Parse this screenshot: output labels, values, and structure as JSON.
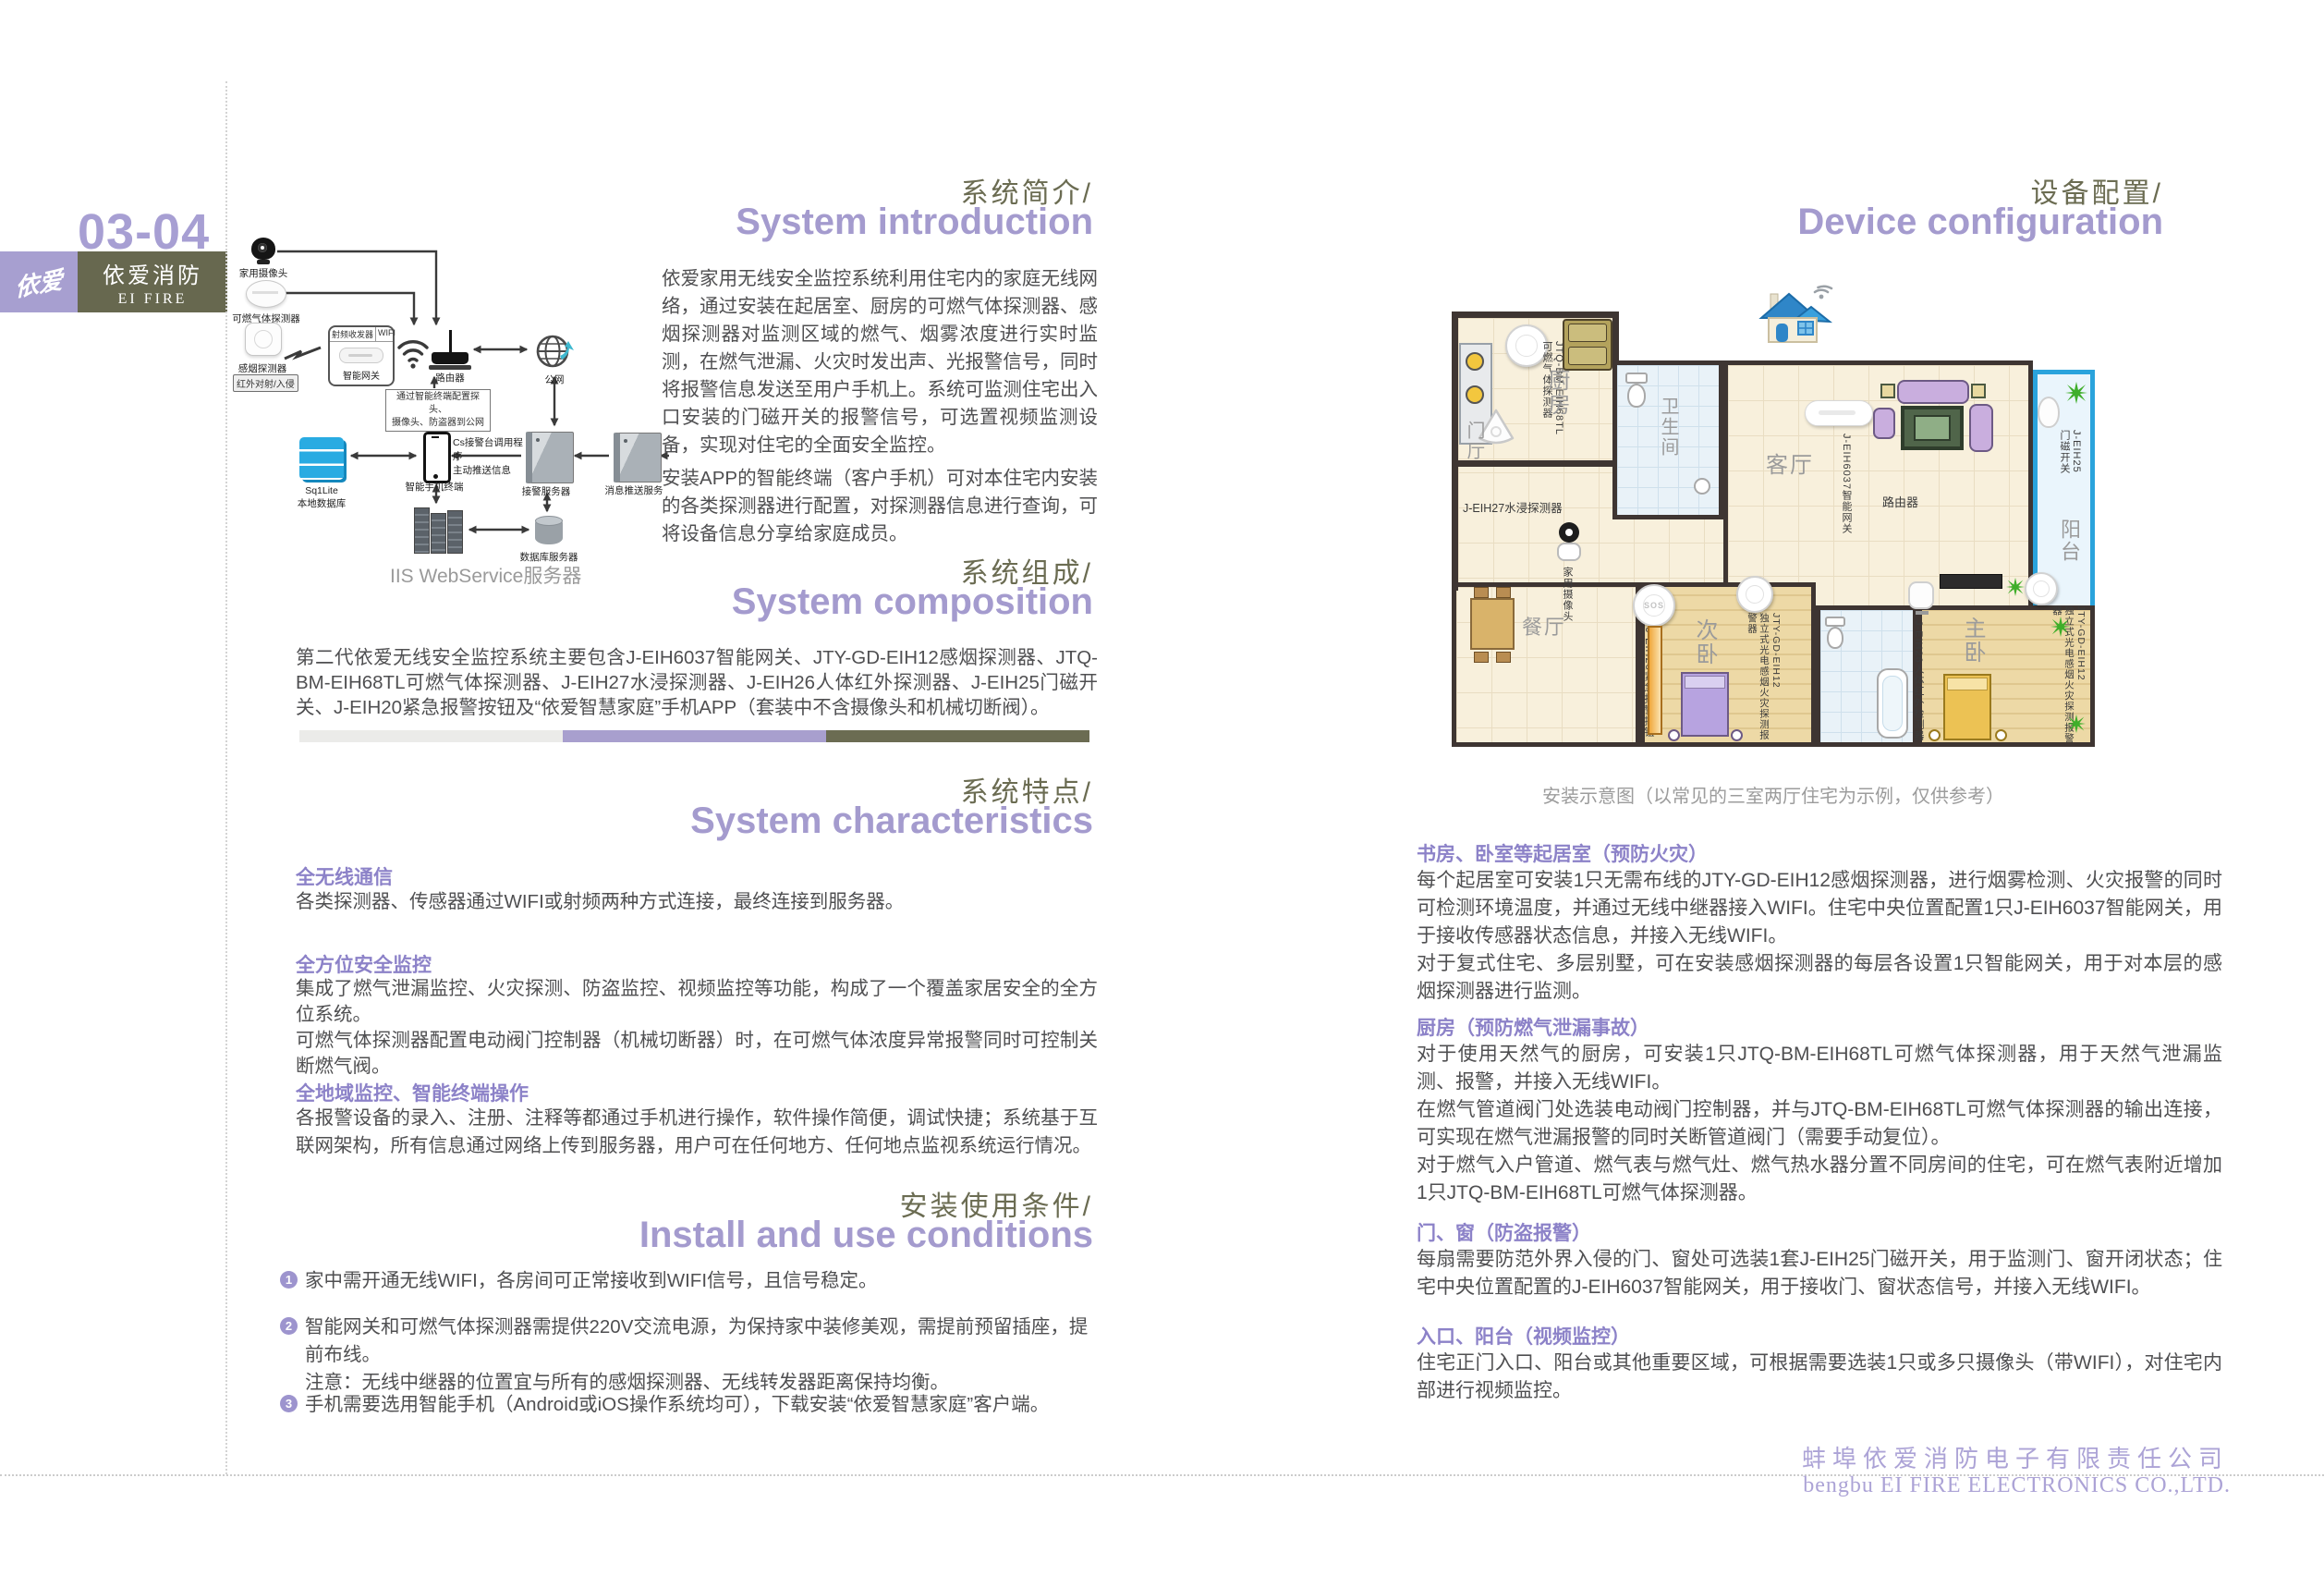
{
  "colors": {
    "accent_purple": "#a49bce",
    "heading_olive": "#6b6c52",
    "subtitle_purple": "#8c82c8",
    "body_text": "#4f4f51",
    "footer_purple": "#aca3d6",
    "sidebar_purple": "#a79fd0",
    "sidebar_olive": "#67684f",
    "balcony_blue": "#2aa3dc",
    "bar": [
      "#ebebe9",
      "#a89fce",
      "#6b6c52"
    ]
  },
  "left": {
    "page_number": "03-04",
    "brand": {
      "logo": "依爱",
      "name_cn": "依爱消防",
      "name_en": "EI FIRE"
    },
    "intro": {
      "title_cn": "系统简介/",
      "title_en": "System introduction",
      "para1": "依爱家用无线安全监控系统利用住宅内的家庭无线网络，通过安装在起居室、厨房的可燃气体探测器、感烟探测器对监测区域的燃气、烟雾浓度进行实时监测，在燃气泄漏、火灾时发出声、光报警信号，同时将报警信息发送至用户手机上。系统可监测住宅出入口安装的门磁开关的报警信号，可选置视频监测设备，实现对住宅的全面安全监控。",
      "para2": "安装APP的智能终端（客户手机）可对本住宅内安装的各类探测器进行配置，对探测器信息进行查询，可将设备信息分享给家庭成员。"
    },
    "composition": {
      "title_cn": "系统组成/",
      "title_en": "System composition",
      "para": "第二代依爱无线安全监控系统主要包含J-EIH6037智能网关、JTY-GD-EIH12感烟探测器、JTQ-BM-EIH68TL可燃气体探测器、J-EIH27水浸探测器、J-EIH26人体红外探测器、J-EIH25门磁开关、J-EIH20紧急报警按钮及“依爱智慧家庭”手机APP（套装中不含摄像头和机械切断阀）。"
    },
    "characteristics": {
      "title_cn": "系统特点/",
      "title_en": "System characteristics",
      "items": [
        {
          "heading": "全无线通信",
          "body": "各类探测器、传感器通过WIFI或射频两种方式连接，最终连接到服务器。"
        },
        {
          "heading": "全方位安全监控",
          "body": "集成了燃气泄漏监控、火灾探测、防盗监控、视频监控等功能，构成了一个覆盖家居安全的全方位系统。\n可燃气体探测器配置电动阀门控制器（机械切断器）时，在可燃气体浓度异常报警同时可控制关断燃气阀。"
        },
        {
          "heading": "全地域监控、智能终端操作",
          "body": "各报警设备的录入、注册、注释等都通过手机进行操作，软件操作简便，调试快捷；系统基于互联网架构，所有信息通过网络上传到服务器，用户可在任何地方、任何地点监视系统运行情况。"
        }
      ]
    },
    "install": {
      "title_cn": "安装使用条件/",
      "title_en": "Install and use conditions",
      "items": [
        {
          "num": "1",
          "text": "家中需开通无线WIFI，各房间可正常接收到WIFI信号，且信号稳定。"
        },
        {
          "num": "2",
          "text": "智能网关和可燃气体探测器需提供220V交流电源，为保持家中装修美观，需提前预留插座，提前布线。\n注意：无线中继器的位置宜与所有的感烟探测器、无线转发器距离保持均衡。"
        },
        {
          "num": "3",
          "text": "手机需要选用智能手机（Android或iOS操作系统均可），下载安装“依爱智慧家庭”客户端。"
        }
      ]
    },
    "diagram": {
      "camera": "家用摄像头",
      "gas": "可燃气体探测器",
      "smoke": "感烟探测器",
      "infrared": "红外对射/入侵",
      "rf": "射频收发器",
      "wifi": "WIFI",
      "gateway": "智能网关",
      "router": "路由器",
      "internet": "公网",
      "note": "通过智能终端配置探头、\n摄像头、防盗器到公网",
      "phone": "智能手机终端",
      "cs_note": "Cs接警台调用程序\n主动推送信息",
      "sqlite": "Sq1Lite\n本地数据库",
      "alarm_server": "接警服务器",
      "push_server": "消息推送服务",
      "db_server": "数据库服务器",
      "iis_caption": "IIS WebService服务器"
    }
  },
  "right": {
    "title_cn": "设备配置/",
    "title_en": "Device configuration",
    "floorplan": {
      "caption": "安装示意图（以常见的三室两厅住宅为示例，仅供参考）",
      "rooms": [
        "厨房",
        "卫生间",
        "客厅",
        "阳台",
        "门厅",
        "餐厅",
        "次卧",
        "主卧"
      ],
      "devices": [
        "JTQ-BM-EIH68TL\n可燃气体探测器",
        "J-EIH27水浸探测器",
        "J-EIH6037智能网关",
        "路由器",
        "家用摄像头",
        "J-EIH25\n门磁开关",
        "J-EIH20紧急报警按钮",
        "JTY-GD-EIH12\n独立式光电感烟火灾探测报警器",
        "J-EIH26人体红外检测器",
        "JTY-GD-EIH12\n独立式光电感烟火灾探测报警器"
      ],
      "sos": "SOS"
    },
    "sections": [
      {
        "heading": "书房、卧室等起居室（预防火灾）",
        "body": "每个起居室可安装1只无需布线的JTY-GD-EIH12感烟探测器，进行烟雾检测、火灾报警的同时可检测环境温度，并通过无线中继器接入WIFI。住宅中央位置配置1只J-EIH6037智能网关，用于接收传感器状态信息，并接入无线WIFI。\n对于复式住宅、多层别墅，可在安装感烟探测器的每层各设置1只智能网关，用于对本层的感烟探测器进行监测。"
      },
      {
        "heading": "厨房（预防燃气泄漏事故）",
        "body": "对于使用天然气的厨房，可安装1只JTQ-BM-EIH68TL可燃气体探测器，用于天然气泄漏监测、报警，并接入无线WIFI。\n在燃气管道阀门处选装电动阀门控制器，并与JTQ-BM-EIH68TL可燃气体探测器的输出连接，可实现在燃气泄漏报警的同时关断管道阀门（需要手动复位）。\n对于燃气入户管道、燃气表与燃气灶、燃气热水器分置不同房间的住宅，可在燃气表附近增加1只JTQ-BM-EIH68TL可燃气体探测器。"
      },
      {
        "heading": "门、窗（防盗报警）",
        "body": "每扇需要防范外界入侵的门、窗处可选装1套J-EIH25门磁开关，用于监测门、窗开闭状态；住宅中央位置配置的J-EIH6037智能网关，用于接收门、窗状态信号，并接入无线WIFI。"
      },
      {
        "heading": "入口、阳台（视频监控）",
        "body": "住宅正门入口、阳台或其他重要区域，可根据需要选装1只或多只摄像头（带WIFI），对住宅内部进行视频监控。"
      }
    ]
  },
  "footer": {
    "company_cn": "蚌埠依爱消防电子有限责任公司",
    "company_en": "bengbu EI FIRE ELECTRONICS CO.,LTD."
  }
}
